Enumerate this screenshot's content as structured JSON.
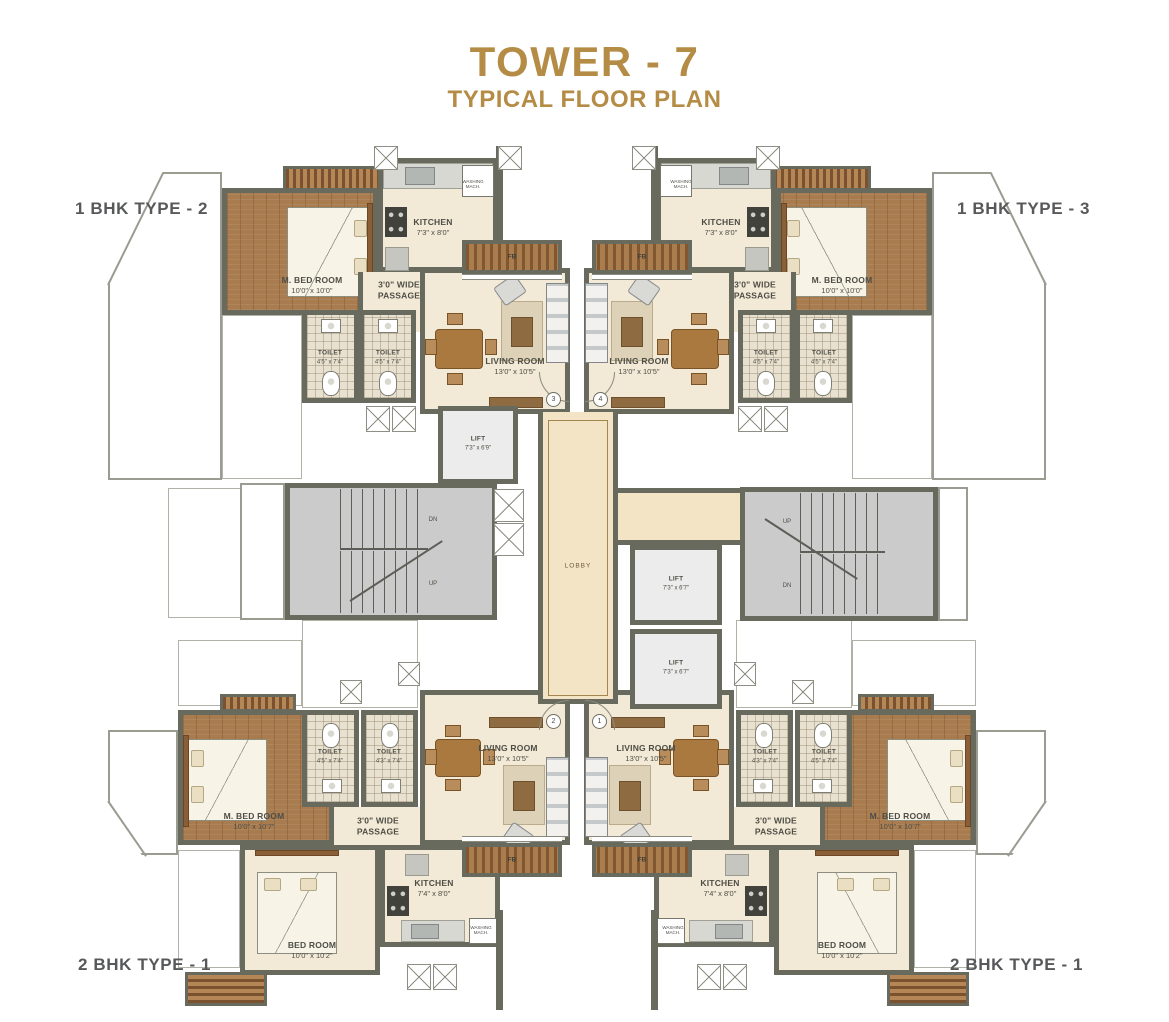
{
  "title": {
    "main": "TOWER - 7",
    "sub": "TYPICAL FLOOR PLAN"
  },
  "corner_labels": {
    "top_left": "1 BHK TYPE - 2",
    "top_right": "1 BHK TYPE - 3",
    "bottom_left": "2 BHK TYPE - 1",
    "bottom_right": "2 BHK TYPE - 1"
  },
  "colors": {
    "accent_gold": "#b58c45",
    "label_gray": "#57585a",
    "wall": "#686a5e",
    "floor_cream": "#f2e9d6",
    "floor_wood": "#a97c50",
    "floor_stair": "#cbcbcb",
    "floor_lift": "#ececec",
    "lobby_floor": "#f3e4c6"
  },
  "units": {
    "top_left": {
      "kitchen": {
        "n": "KITCHEN",
        "d": "7'3\" x 8'0\""
      },
      "m_bedroom": {
        "n": "M. BED ROOM",
        "d": "10'0\" x 10'0\""
      },
      "passage": {
        "n": "3'0\" WIDE",
        "d": "PASSAGE"
      },
      "toilet_1": {
        "n": "TOILET",
        "d": "4'5\" x 7'4\""
      },
      "toilet_2": {
        "n": "TOILET",
        "d": "4'5\" x 7'4\""
      },
      "living": {
        "n": "LIVING ROOM",
        "d": "13'0\" x 10'5\""
      },
      "flower_bed": "FB",
      "washing": {
        "n": "WASHING",
        "d": "MACH."
      }
    },
    "top_right": {
      "kitchen": {
        "n": "KITCHEN",
        "d": "7'3\" x 8'0\""
      },
      "m_bedroom": {
        "n": "M. BED ROOM",
        "d": "10'0\" x 10'0\""
      },
      "passage": {
        "n": "3'0\" WIDE",
        "d": "PASSAGE"
      },
      "toilet_1": {
        "n": "TOILET",
        "d": "4'5\" x 7'4\""
      },
      "toilet_2": {
        "n": "TOILET",
        "d": "4'5\" x 7'4\""
      },
      "living": {
        "n": "LIVING ROOM",
        "d": "13'0\" x 10'5\""
      },
      "flower_bed": "FB",
      "washing": {
        "n": "WASHING",
        "d": "MACH."
      }
    },
    "bottom_left": {
      "m_bedroom": {
        "n": "M. BED ROOM",
        "d": "10'0\" x 10'7\""
      },
      "toilet_1": {
        "n": "TOILET",
        "d": "4'5\" x 7'4\""
      },
      "toilet_2": {
        "n": "TOILET",
        "d": "4'3\" x 7'4\""
      },
      "living": {
        "n": "LIVING ROOM",
        "d": "13'0\" x 10'5\""
      },
      "passage": {
        "n": "3'0\" WIDE",
        "d": "PASSAGE"
      },
      "bedroom": {
        "n": "BED ROOM",
        "d": "10'0\" x 10'2\""
      },
      "kitchen": {
        "n": "KITCHEN",
        "d": "7'4\" x 8'0\""
      },
      "flower_bed": "FB",
      "washing": {
        "n": "WASHING",
        "d": "MACH."
      }
    },
    "bottom_right": {
      "m_bedroom": {
        "n": "M. BED ROOM",
        "d": "10'0\" x 10'7\""
      },
      "toilet_1": {
        "n": "TOILET",
        "d": "4'3\" x 7'4\""
      },
      "toilet_2": {
        "n": "TOILET",
        "d": "4'5\" x 7'4\""
      },
      "living": {
        "n": "LIVING ROOM",
        "d": "13'0\" x 10'5\""
      },
      "passage": {
        "n": "3'0\" WIDE",
        "d": "PASSAGE"
      },
      "bedroom": {
        "n": "BED ROOM",
        "d": "10'0\" x 10'2\""
      },
      "kitchen": {
        "n": "KITCHEN",
        "d": "7'4\" x 8'0\""
      },
      "flower_bed": "FB",
      "washing": {
        "n": "WASHING",
        "d": "MACH."
      }
    }
  },
  "core": {
    "lift_top": {
      "n": "LIFT",
      "d": "7'3\" x 6'9\""
    },
    "lift_mid": {
      "n": "LIFT",
      "d": "7'3\" x 6'7\""
    },
    "lift_bottom": {
      "n": "LIFT",
      "d": "7'3\" x 6'7\""
    },
    "lobby": "LOBBY",
    "stairs_left": {
      "top": "DN",
      "bottom": "UP"
    },
    "stairs_right": {
      "top": "UP",
      "bottom": "DN"
    }
  },
  "entrance_numbers": {
    "top_left": "3",
    "top_right": "4",
    "bottom_left": "2",
    "bottom_right": "1"
  }
}
